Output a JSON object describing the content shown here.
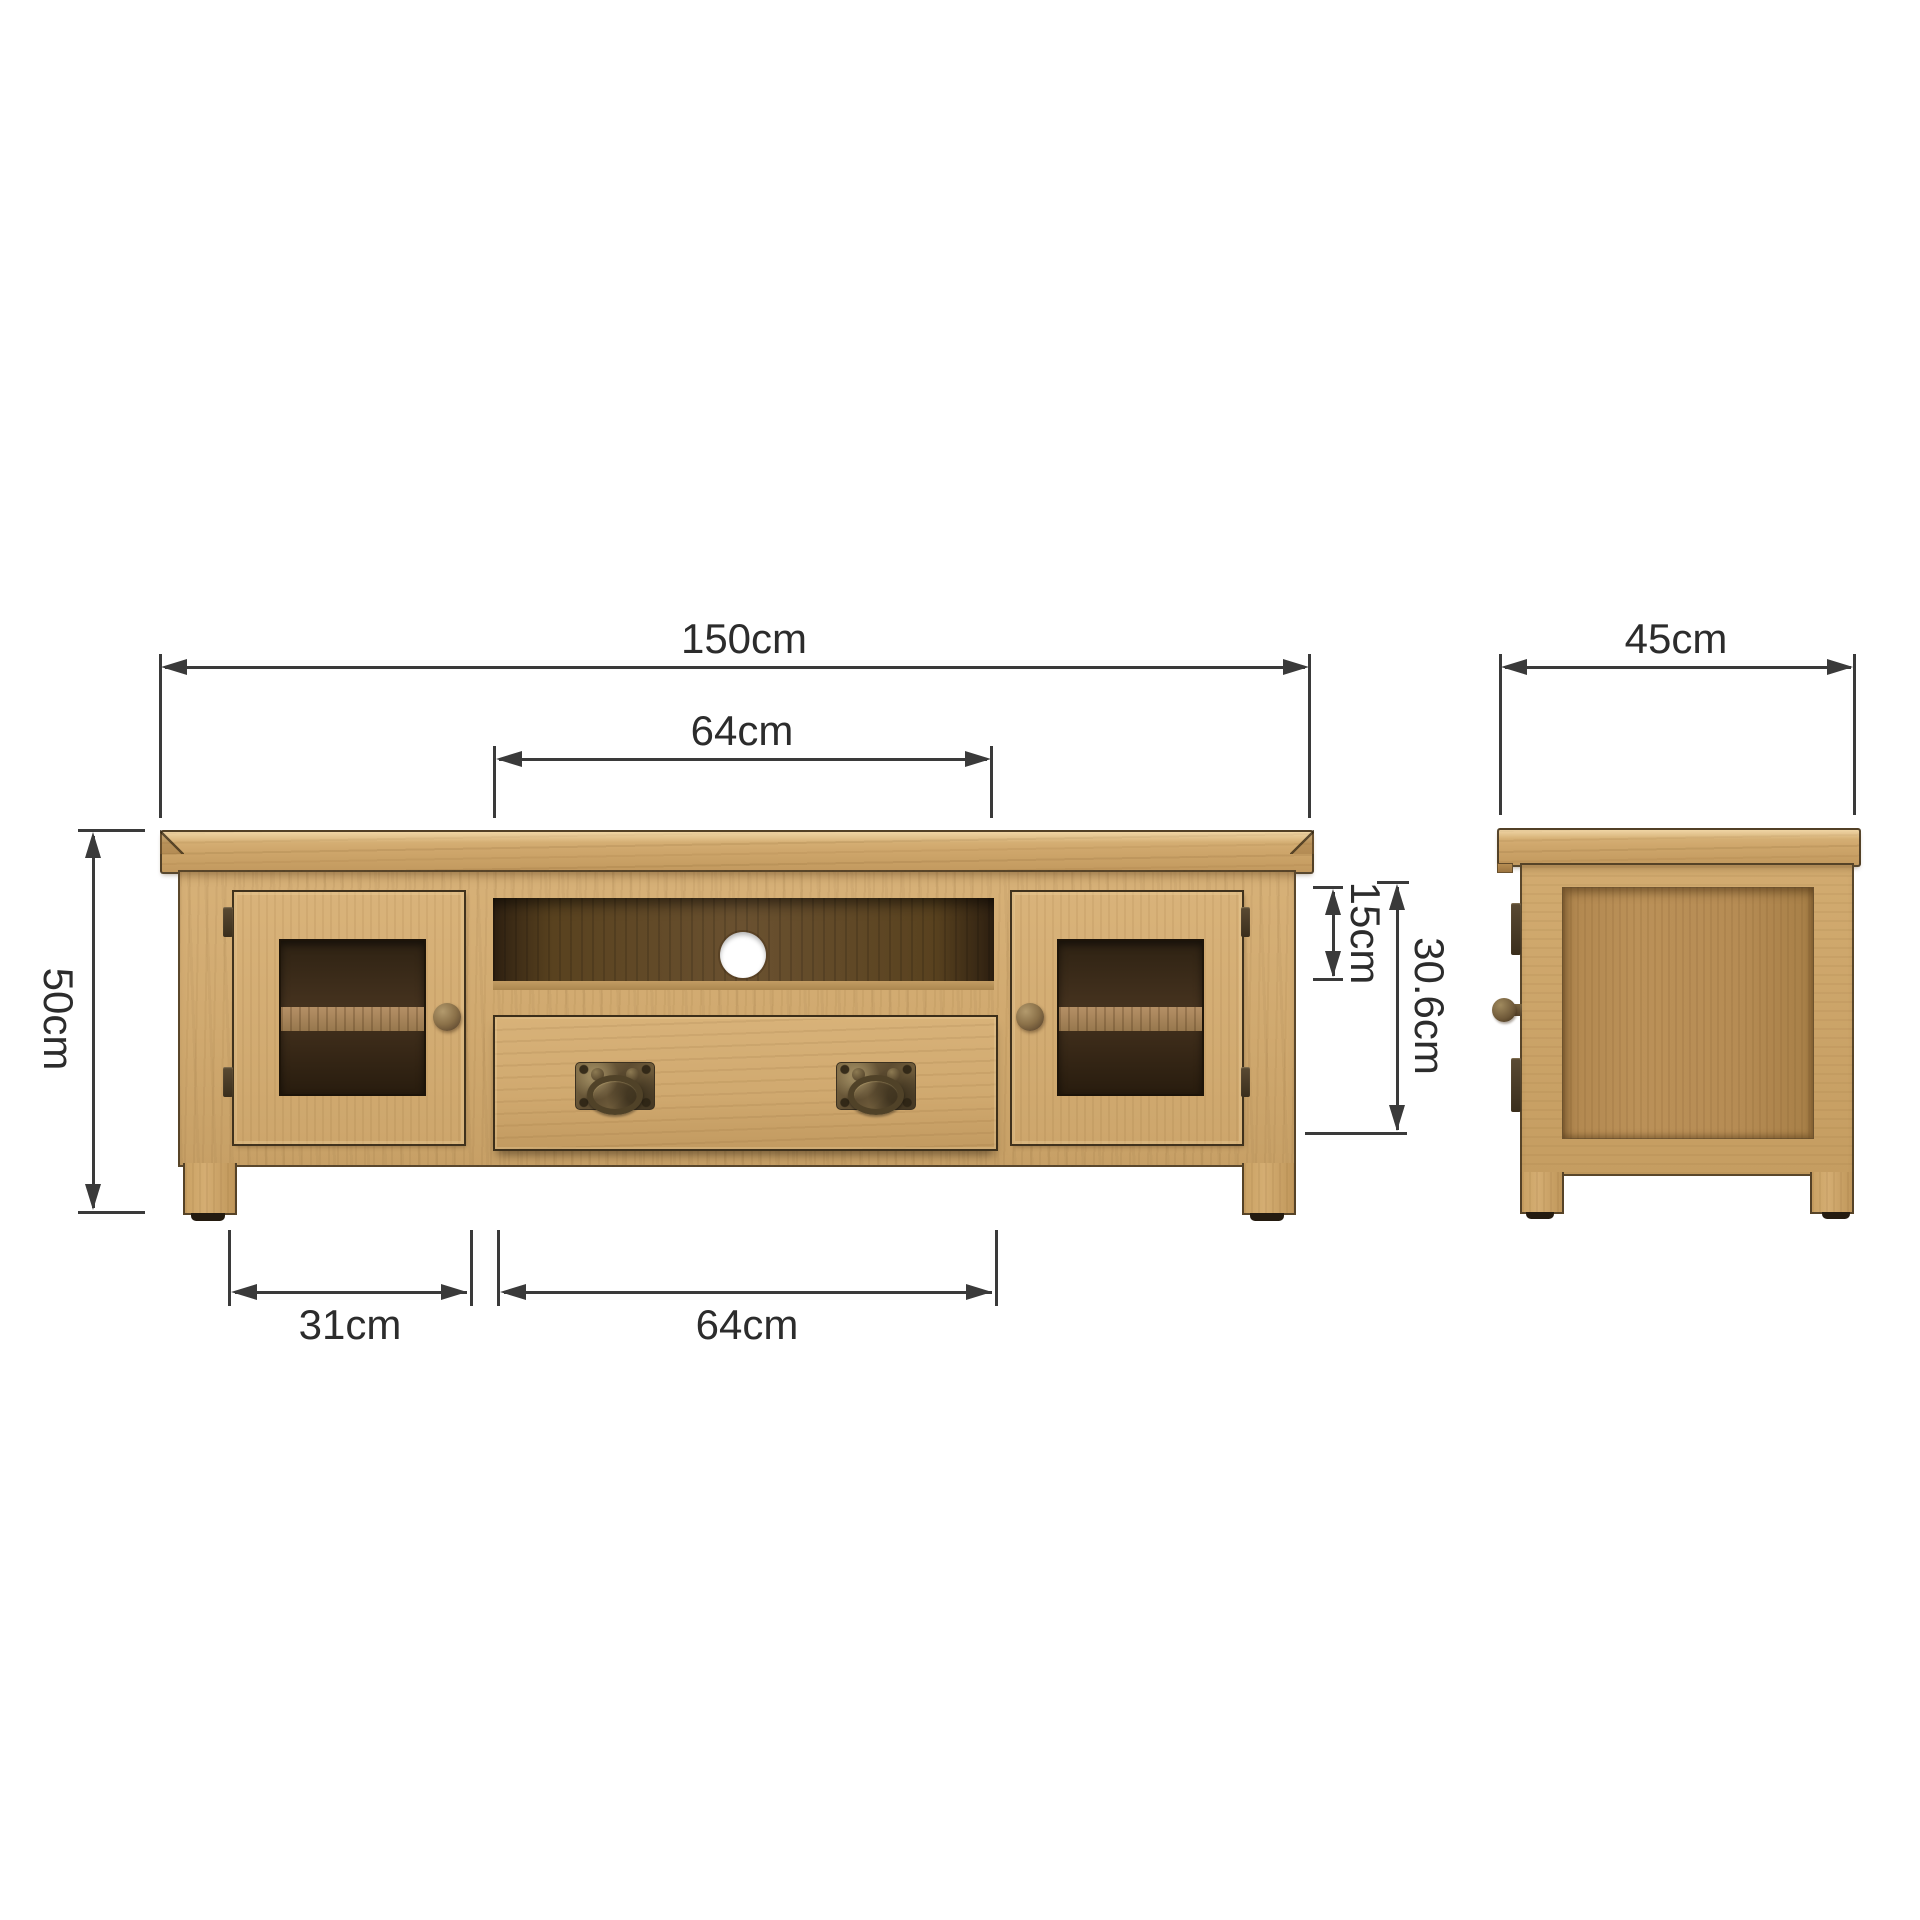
{
  "diagram": {
    "kind": "furniture-dimension-drawing",
    "views": {
      "front": {
        "features": [
          "top-board",
          "left-glazed-door",
          "open-shelf",
          "cable-hole",
          "drawer",
          "right-glazed-door",
          "legs"
        ]
      },
      "side": {
        "features": [
          "top-board",
          "framed-side-panel",
          "door-knob",
          "hinges",
          "legs"
        ]
      }
    },
    "dims": {
      "overall_width": {
        "label": "150cm",
        "value": 150,
        "unit": "cm"
      },
      "opening_width_top": {
        "label": "64cm",
        "value": 64,
        "unit": "cm"
      },
      "depth": {
        "label": "45cm",
        "value": 45,
        "unit": "cm"
      },
      "overall_height": {
        "label": "50cm",
        "value": 50,
        "unit": "cm"
      },
      "opening_height": {
        "label": "15cm",
        "value": 15,
        "unit": "cm"
      },
      "front_opening_height": {
        "label": "30.6cm",
        "value": 30.6,
        "unit": "cm"
      },
      "door_width": {
        "label": "31cm",
        "value": 31,
        "unit": "cm"
      },
      "drawer_width": {
        "label": "64cm",
        "value": 64,
        "unit": "cm"
      }
    },
    "colors": {
      "background": "#ffffff",
      "wood_light": "#d7b178",
      "wood_mid": "#cfa76c",
      "wood_panel": "#b68c54",
      "interior_dark": "#46331f",
      "metal_bronze": "#5d4c31",
      "dimension_line": "#3a3a3a",
      "label_text": "#2c2c2c"
    }
  }
}
